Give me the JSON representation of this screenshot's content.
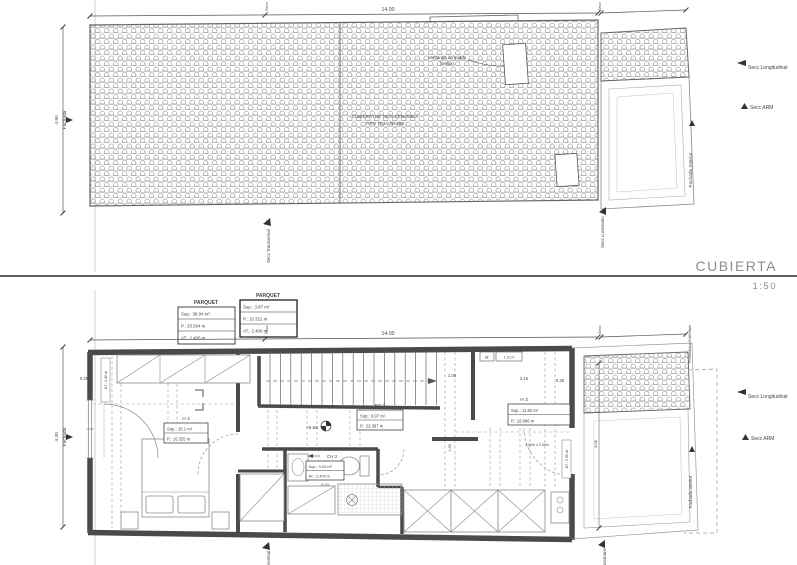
{
  "sheet": {
    "divider_title": "CUBIERTA",
    "divider_scale": "1:50"
  },
  "roof_plan": {
    "dim_width_top": "14.00",
    "dim_facade_value": "4.90",
    "dim_facade_label": "Fachada",
    "skylight_note_line1": "Ventanas de tejado",
    "skylight_note_line2": "(Velux)",
    "roof_note_line1": "CUBIERTA DE TEJA CERÁMICA",
    "roof_note_line2": "TIPO TEJA ÁRABE",
    "secc_top_left": "Secc",
    "secc_top_right": "Secc",
    "secc_longitudinal": "Secc Longitudinal",
    "secc_arm": "Secc ARM",
    "secc_lucernario": "Secc Lucernario",
    "secc_transversal": "Secc Transversal",
    "fachada_interior": "Fachada Interior"
  },
  "floor_plan": {
    "dim_width_top": "14.00",
    "dim_facade_value": "4.30",
    "dim_facade_label": "Fachada",
    "legend_parquet_left": {
      "title": "PARQUET",
      "sup": "Sup.: 38.04 m²",
      "p": "P.: 33.504 m",
      "at": "AT.: 2.400 m"
    },
    "legend_parquet_right": {
      "title": "PARQUET",
      "sup": "Sup.: 3.87 m²",
      "p": "P.: 10.321 m",
      "at": "AT.: 2.400 m"
    },
    "room_h4": {
      "name": "H 4",
      "sup": "Sup.: 15.1 m²",
      "p": "P.: 16.325 m"
    },
    "room_ec2": {
      "name": "EC 2",
      "sup": "Sup.: 6.97 m²",
      "p": "P.: 22.397 m"
    },
    "room_ch3": {
      "name": "CH 3",
      "sup": "Sup.: 3.29 m²",
      "at": "AT.: 2.400 m",
      "dim_below": "0.70"
    },
    "room_h3": {
      "name": "H 3",
      "sup": "Sup.: 11.82 m²",
      "p": "P.: 16.086 m"
    },
    "level_mark": "+6.66",
    "dim_025": "0.25",
    "dim_100": "1.00",
    "dim_216": "2.16",
    "dim_035": "0.35",
    "dim_198": "1.98",
    "dim_306": "3.06",
    "dim_door": "2.00m x 2.00m",
    "dim_at_240": "AT.: 2.40 m",
    "dim_at_250": "AT.: 2.50 m",
    "window_sill_label": "alf.",
    "window_sill_value": "1.10 m",
    "secc_top_left": "Secc",
    "secc_top_right": "Secc",
    "secc_longitudinal": "Secc Longitudinal",
    "secc_arm": "Secc ARM",
    "secc_lucernario": "Secc Lucernario",
    "secc_transversal": "Secc Transversal",
    "fachada_interior": "Fachada Interior",
    "profundidad_edificable": "Profundidad Edificable"
  }
}
